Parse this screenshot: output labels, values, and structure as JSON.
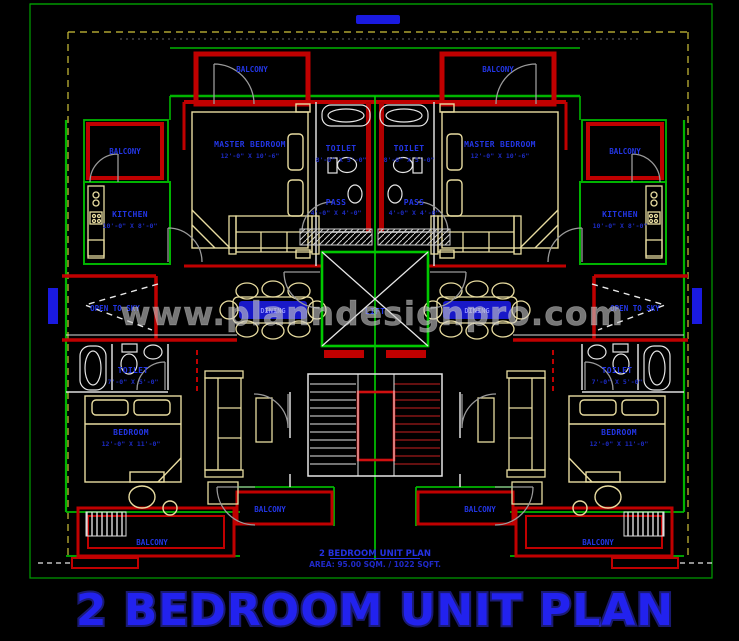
{
  "title": {
    "main": "2 BEDROOM UNIT PLAN",
    "sub_name": "2 BEDROOM UNIT PLAN",
    "sub_area": "AREA: 95.00 SQM. / 1022 SQFT."
  },
  "watermark": "www.planndesignpro.com",
  "rooms": {
    "master_bedroom": {
      "label": "MASTER BEDROOM",
      "dims": "12'-0\" X 10'-6\""
    },
    "toilet_top": {
      "label": "TOILET",
      "dims": "8'-0\" X 5'-0\""
    },
    "kitchen": {
      "label": "KITCHEN",
      "dims": "10'-0\" X 8'-0\""
    },
    "pass": {
      "label": "PASS",
      "dims": "4'-0\" X 4'-0\""
    },
    "bedroom": {
      "label": "BEDROOM",
      "dims": "12'-0\" X 11'-0\""
    },
    "toilet_bottom": {
      "label": "TOILET",
      "dims": "7'-0\" X 5'-0\""
    },
    "balcony": {
      "label": "BALCONY"
    },
    "open_to_sky": {
      "label": "OPEN TO SKY"
    },
    "lift": {
      "label": "LIFT"
    },
    "dining": {
      "label": "DINING"
    }
  },
  "colors": {
    "background": "#000000",
    "wall_green": "#00b400",
    "wall_red": "#c00000",
    "furniture_cream": "#e8dca0",
    "fixture_white": "#e6e6e6",
    "door_gray": "#9a9a9a",
    "label_blue": "#2336e6",
    "title_blue": "#2222ee",
    "boundary_yellow": "#cfc23a",
    "watermark_gray": "#c6c6c6"
  }
}
